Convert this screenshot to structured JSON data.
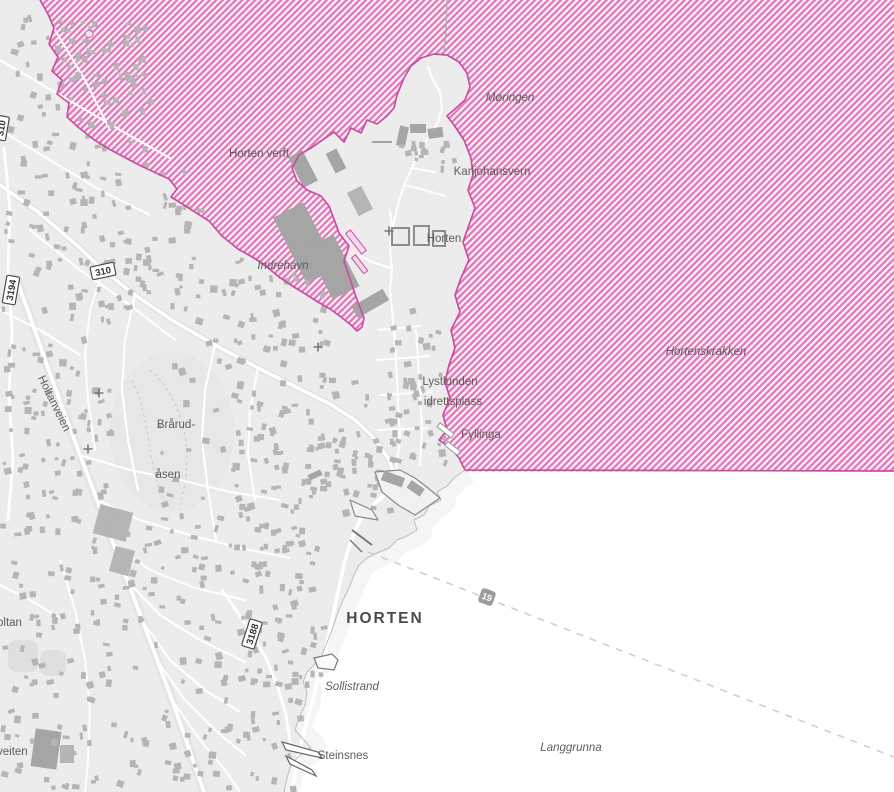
{
  "colors": {
    "sea": "#ffffff",
    "sea-shallow": "#f2f2f2",
    "land": "#ececec",
    "building": "#b5b5b5",
    "building-dark": "#a5a5a5",
    "road": "#ffffff",
    "coastline": "#bdbdbd",
    "hatch-stripe": "#e07ab9",
    "hatch-gap": "#fceef7",
    "hatch-border": "#cf4aa2",
    "label": "#5d5d5d",
    "city-label": "#4a4a4a",
    "ferry-line": "#cfcfcf",
    "shield-bg": "#ffffff",
    "shield-border": "#4a4a4a",
    "shield-text": "#333333",
    "ferry-shield-bg": "#9b9b9b",
    "ferry-shield-text": "#ffffff"
  },
  "map": {
    "labels": [
      {
        "id": "moringen",
        "text": "Møringen",
        "x": 510,
        "y": 101,
        "italic": true
      },
      {
        "id": "horten-verft",
        "text": "Horten verft",
        "x": 259,
        "y": 157
      },
      {
        "id": "karljohansvern",
        "text": "Karljohansvern",
        "x": 492,
        "y": 175
      },
      {
        "id": "horten",
        "text": "Horten",
        "x": 444,
        "y": 242
      },
      {
        "id": "indrehavn",
        "text": "Indrehavn",
        "x": 283,
        "y": 269,
        "italic": true
      },
      {
        "id": "hortenskrakken",
        "text": "Hortenskrakken",
        "x": 706,
        "y": 355,
        "italic": true
      },
      {
        "id": "lystlunden",
        "text": "Lystlunden",
        "x": 450,
        "y": 385
      },
      {
        "id": "idrettsplass",
        "text": "idrettsplass",
        "x": 453,
        "y": 405
      },
      {
        "id": "fyllinga",
        "text": "Fyllinga",
        "x": 481,
        "y": 438
      },
      {
        "id": "brarud",
        "text": "Brårud-",
        "x": 176,
        "y": 428
      },
      {
        "id": "asen",
        "text": "åsen",
        "x": 168,
        "y": 478
      },
      {
        "id": "holtanveien",
        "text": "Holtanveien",
        "x": 51,
        "y": 405,
        "rotate": 64
      },
      {
        "id": "horten-city",
        "text": "HORTEN",
        "x": 385,
        "y": 623,
        "city": true
      },
      {
        "id": "sollistrand",
        "text": "Sollistrand",
        "x": 352,
        "y": 690,
        "italic": true
      },
      {
        "id": "steinsnes",
        "text": "Steinsnes",
        "x": 343,
        "y": 759
      },
      {
        "id": "langgrunna",
        "text": "Langgrunna",
        "x": 571,
        "y": 751,
        "italic": true
      }
    ],
    "edge_labels": [
      {
        "id": "oltan-partial",
        "text": "oltan",
        "x": -3,
        "y": 626
      },
      {
        "id": "veiten-partial",
        "text": "veiten",
        "x": -3,
        "y": 755
      }
    ],
    "road_shields": [
      {
        "id": "shield-310",
        "value": "310",
        "x": 103,
        "y": 271,
        "rotate": -12,
        "w": 24,
        "h": 13
      },
      {
        "id": "shield-3194",
        "value": "3194",
        "x": 11,
        "y": 290,
        "rotate": -80,
        "w": 28,
        "h": 13
      },
      {
        "id": "shield-3188",
        "value": "3188",
        "x": 252,
        "y": 634,
        "rotate": -72,
        "w": 28,
        "h": 13
      },
      {
        "id": "shield-310-edge",
        "value": "310",
        "x": 1,
        "y": 128,
        "rotate": -80,
        "w": 24,
        "h": 13
      }
    ],
    "ferry_shields": [
      {
        "id": "ferry-19",
        "value": "19",
        "x": 487,
        "y": 597,
        "rotate": 20,
        "w": 15,
        "h": 15
      }
    ],
    "church_crosses": [
      {
        "x": 389,
        "y": 231
      },
      {
        "x": 318,
        "y": 347
      },
      {
        "x": 99,
        "y": 393
      },
      {
        "x": 88,
        "y": 449
      }
    ]
  }
}
